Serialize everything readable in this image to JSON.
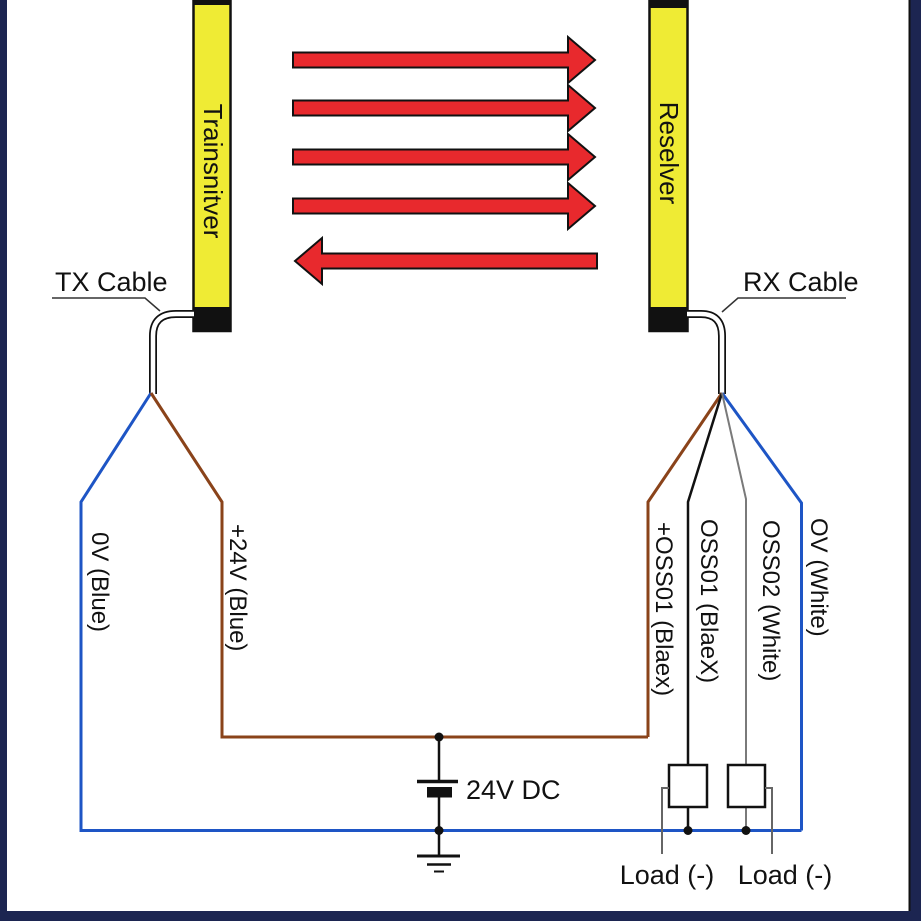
{
  "colors": {
    "navy": "#1c2551",
    "yellow": "#efeb34",
    "red": "#e8292d",
    "blue": "#1e55c5",
    "brown": "#8a431a",
    "gray": "#7a7a7a",
    "leader_gray": "#666666",
    "wire_black": "#111111"
  },
  "devices": {
    "transmitter_label": "Trainsnitver",
    "receiver_label": "Reselver"
  },
  "cables": {
    "tx_label": "TX Cable",
    "rx_label": "RX Cable"
  },
  "wires": {
    "tx_0v": "0V (Blue)",
    "tx_24v": "+24V (Blue)",
    "rx_oss01_plus": "+OSS01 (Blaex)",
    "rx_oss01": "OSS01 (BlaeX)",
    "rx_oss02": "OSS02 (White)",
    "rx_0v": "OV (White)"
  },
  "power": {
    "supply_label": "24V DC"
  },
  "loads": {
    "load1_label": "Load (-)",
    "load2_label": "Load (-)"
  }
}
